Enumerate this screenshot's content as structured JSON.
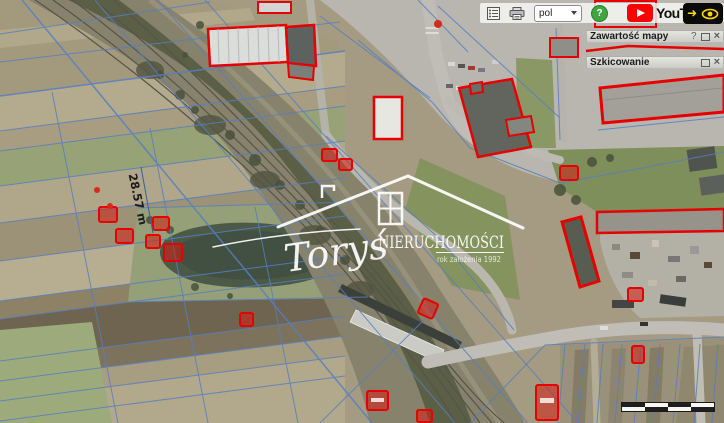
{
  "toolbar": {
    "language": {
      "value": "pol"
    },
    "help_label": "?",
    "youtube_label": "YouTube",
    "arrow_glyph": "➜"
  },
  "panels": {
    "map_contents": {
      "title": "Zawartość mapy",
      "help_label": "?",
      "close_label": "×"
    },
    "sketching": {
      "title": "Szkicowanie",
      "close_label": "×"
    }
  },
  "watermark": {
    "script": "Toryś",
    "name": "NIERUCHOMOŚCI",
    "subtitle": "rok założenia 1992"
  },
  "map": {
    "measurement_label": "28.57 m"
  },
  "colors": {
    "parcel_line": "#567fc0",
    "building_outline": "#e60000",
    "youtube_red": "#ff0000",
    "help_green": "#3fa63f",
    "accent_yellow": "#ffd800"
  }
}
